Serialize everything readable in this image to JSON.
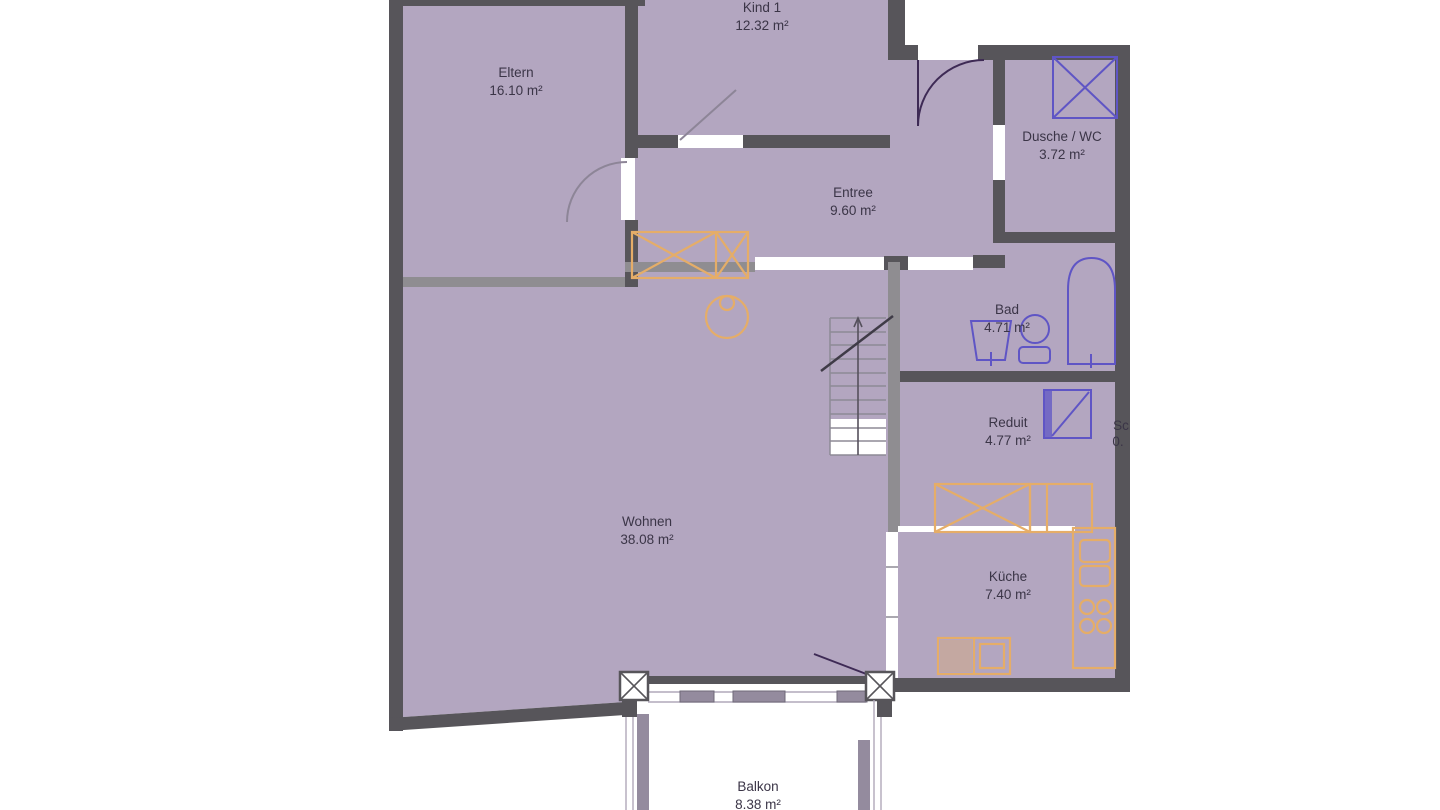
{
  "colors": {
    "floor": "#b3a6c0",
    "wall-dark": "#57555a",
    "wall-med": "#8f8d91",
    "furniture": "#e5ad68",
    "fixture": "#5f55c5",
    "door": "#3e2a55",
    "text": "#3b3547"
  },
  "rooms": [
    {
      "name": "Eltern",
      "area": "16.10 m²"
    },
    {
      "name": "Kind 1",
      "area": "12.32 m²"
    },
    {
      "name": "Entree",
      "area": "9.60 m²"
    },
    {
      "name": "Dusche / WC",
      "area": "3.72 m²"
    },
    {
      "name": "Bad",
      "area": "4.71 m²"
    },
    {
      "name": "Reduit",
      "area": "4.77 m²"
    },
    {
      "name": "Wohnen",
      "area": "38.08 m²"
    },
    {
      "name": "Küche",
      "area": "7.40 m²"
    },
    {
      "name": "Balkon",
      "area": "8.38 m²"
    },
    {
      "name": "Sc",
      "area": "0."
    }
  ]
}
